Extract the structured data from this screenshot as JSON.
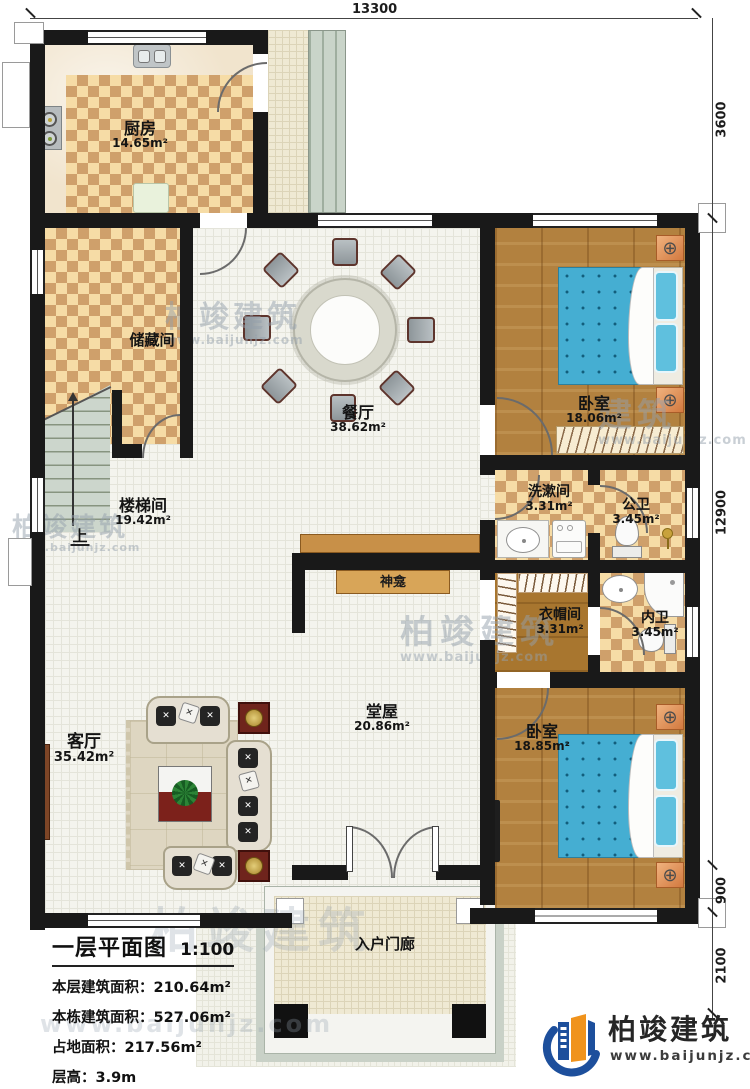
{
  "dimensions": {
    "top": "13300",
    "right_top": "3600",
    "right_main": "12900",
    "right_lower": "900",
    "right_bottom": "2100"
  },
  "rooms": {
    "kitchen": {
      "name": "厨房",
      "area": "14.65m²"
    },
    "storage": {
      "name": "储藏间",
      "area": ""
    },
    "stairwell": {
      "name": "楼梯间",
      "area": "19.42m²"
    },
    "dining": {
      "name": "餐厅",
      "area": "38.62m²"
    },
    "bedroom1": {
      "name": "卧室",
      "area": "18.06m²"
    },
    "washroom": {
      "name": "洗漱间",
      "area": "3.31m²"
    },
    "public_bath": {
      "name": "公卫",
      "area": "3.45m²"
    },
    "cloakroom": {
      "name": "衣帽间",
      "area": "3.31m²"
    },
    "inner_bath": {
      "name": "内卫",
      "area": "3.45m²"
    },
    "hall": {
      "name": "堂屋",
      "area": "20.86m²"
    },
    "living": {
      "name": "客厅",
      "area": "35.42m²"
    },
    "bedroom2": {
      "name": "卧室",
      "area": "18.85m²"
    },
    "porch": {
      "name": "入户门廊",
      "area": ""
    }
  },
  "annotations": {
    "shrine": "神龛",
    "stairs_up": "上"
  },
  "title_block": {
    "title": "一层平面图",
    "scale": "1:100",
    "lines": [
      "本层建筑面积：210.64m²",
      "本栋建筑面积：527.06m²",
      "占地面积：217.56m²",
      "层高：3.9m"
    ]
  },
  "brand": {
    "name": "柏竣建筑",
    "website": "www.baijunjz.com"
  },
  "watermark": {
    "name": "柏竣建筑",
    "short": "建筑",
    "website": "www.baijunjz.com"
  },
  "colors": {
    "wall": "#191919",
    "checker_dark": "#cfa06b",
    "checker_light": "#f6dca6",
    "wood_floor": "#b2813f",
    "bed_blue": "#45aed2",
    "brand_blue": "#1d4f9c",
    "brand_orange": "#f0931c"
  }
}
